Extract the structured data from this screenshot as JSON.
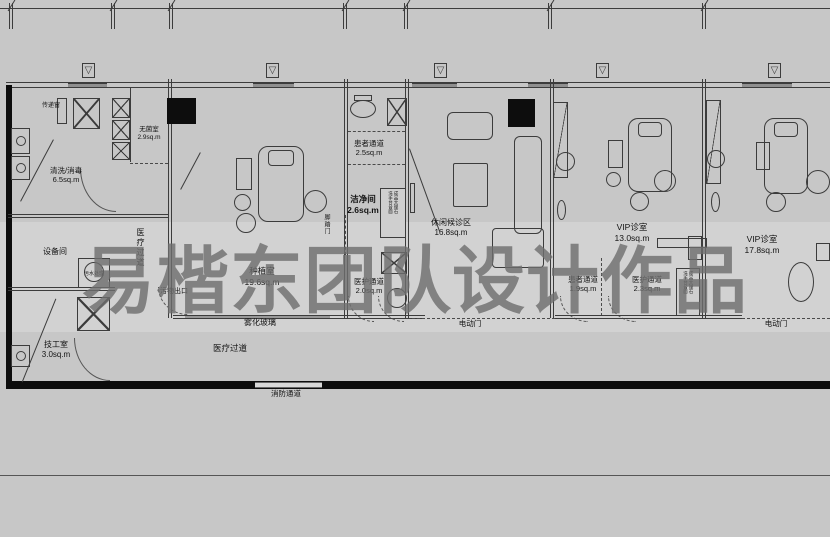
{
  "watermark": {
    "text": "易楷东团队设计作品"
  },
  "icons": {
    "vent": "▽"
  },
  "rooms": {
    "wash": {
      "name": "清洗/消毒",
      "area": "6.5sq.m"
    },
    "sterile": {
      "name": "无菌室",
      "area": "2.9sq.m"
    },
    "equipment": {
      "name": "设备间"
    },
    "tech": {
      "name": "技工室",
      "area": "3.0sq.m"
    },
    "implant": {
      "name": "种植室",
      "area": "19.6sq.m"
    },
    "clean": {
      "name": "洁净间",
      "area": "2.6sq.m"
    },
    "waiting": {
      "name": "休闲候诊区",
      "area": "16.8sq.m"
    },
    "vip1": {
      "name": "VIP诊室",
      "area": "13.0sq.m"
    },
    "vip2": {
      "name": "VIP诊室",
      "area": "17.8sq.m"
    }
  },
  "corridors": {
    "patient_top": {
      "name": "患者通道",
      "area": "2.5sq.m"
    },
    "staff_left": {
      "name": "医护通道",
      "area": "2.0sq.m"
    },
    "patient_right": {
      "name": "患者通道",
      "area": "1.9sq.m"
    },
    "staff_right": {
      "name": "医护通道",
      "area": "2.3sq.m"
    },
    "medical_vertical": "医疗过道",
    "medical_bottom": "医疗过道",
    "fire": "消防通道"
  },
  "annotations": {
    "pass_window": "传递窗",
    "sewage": "污水处理",
    "waste_exit": "污物出口",
    "fog_glass": "雾化玻璃",
    "electric_door_left": "电动门",
    "electric_door_right": "电动门",
    "foot_door": "脚踏门",
    "basin_col_a": "成品大理石",
    "basin_col_b": "洗手台台面"
  },
  "colors": {
    "background": "#c7c7c7",
    "light_band": "#d2d2d2",
    "line": "#3c3c3c",
    "wall_fill": "#0d0d0d",
    "watermark": "#6e6e6e"
  }
}
